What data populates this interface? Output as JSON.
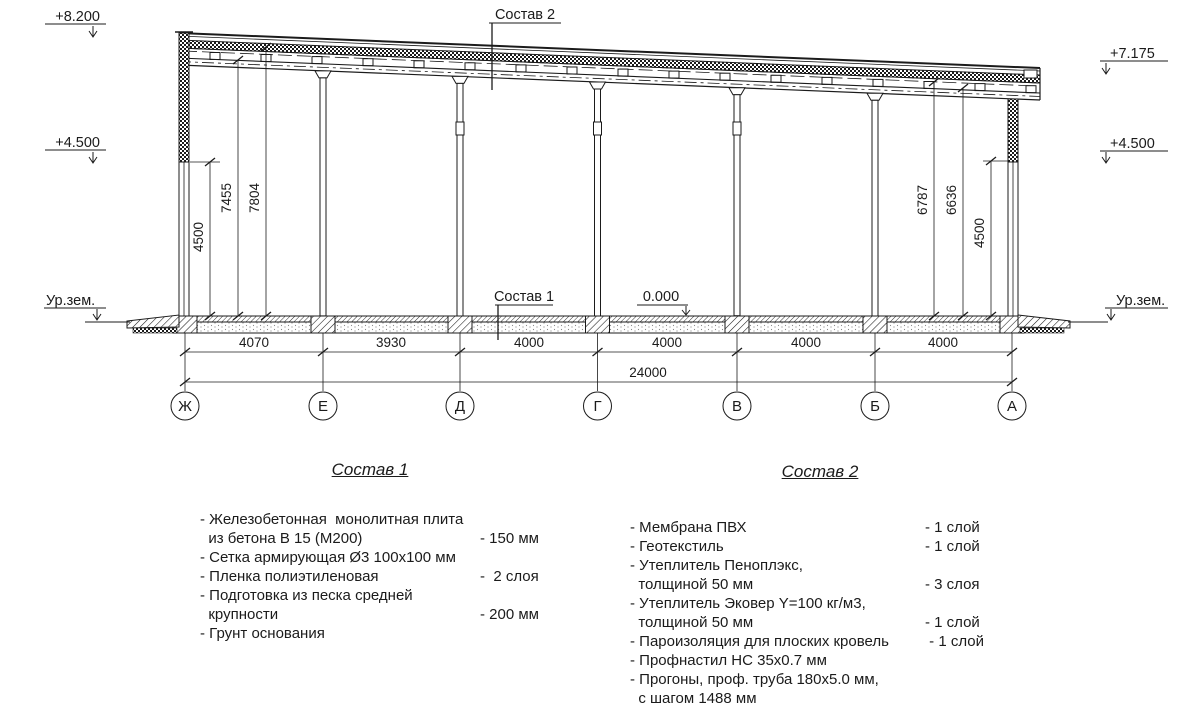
{
  "drawing": {
    "elevation_marks": {
      "top_left": "+8.200",
      "left_mid": "+4.500",
      "top_right": "+7.175",
      "right_mid": "+4.500",
      "zero_level": "0.000",
      "ground_left": "Ур.зем.",
      "ground_right": "Ур.зем."
    },
    "callouts": {
      "roof_layers": "Состав 2",
      "floor_layers": "Состав 1"
    },
    "vertical_dims_left": [
      "4500",
      "7455",
      "7804"
    ],
    "vertical_dims_right": [
      "6787",
      "6636",
      "4500"
    ],
    "bay_dims": [
      "4070",
      "3930",
      "4000",
      "4000",
      "4000",
      "4000"
    ],
    "overall_dim": "24000",
    "axes": [
      "Ж",
      "Е",
      "Д",
      "Г",
      "В",
      "Б",
      "А"
    ]
  },
  "spec1": {
    "title": "Состав 1",
    "lines": [
      {
        "t": "- Железобетонная  монолитная плита",
        "v": ""
      },
      {
        "t": "  из бетона В 15 (М200)",
        "v": "- 150 мм"
      },
      {
        "t": "- Сетка армирующая Ø3 100x100 мм",
        "v": ""
      },
      {
        "t": "- Пленка полиэтиленовая",
        "v": "-  2 слоя"
      },
      {
        "t": "- Подготовка из песка средней",
        "v": ""
      },
      {
        "t": "  крупности",
        "v": "- 200 мм"
      },
      {
        "t": "- Грунт основания",
        "v": ""
      }
    ]
  },
  "spec2": {
    "title": "Состав 2",
    "lines": [
      {
        "t": "- Мембрана ПВХ",
        "v": "- 1 слой"
      },
      {
        "t": "- Геотекстиль",
        "v": "- 1 слой"
      },
      {
        "t": "- Утеплитель Пеноплэкс,",
        "v": ""
      },
      {
        "t": "  толщиной 50 мм",
        "v": "- 3 слоя"
      },
      {
        "t": "- Утеплитель Эковер Y=100 кг/м3,",
        "v": ""
      },
      {
        "t": "  толщиной 50 мм",
        "v": "- 1 слой"
      },
      {
        "t": "- Пароизоляция для плоских кровель",
        "v": " - 1 слой"
      },
      {
        "t": "- Профнастил НС 35х0.7 мм",
        "v": ""
      },
      {
        "t": "- Прогоны, проф. труба 180х5.0 мм,",
        "v": ""
      },
      {
        "t": "  с шагом 1488 мм",
        "v": ""
      },
      {
        "t": "- Металлические балки",
        "v": ""
      }
    ]
  }
}
